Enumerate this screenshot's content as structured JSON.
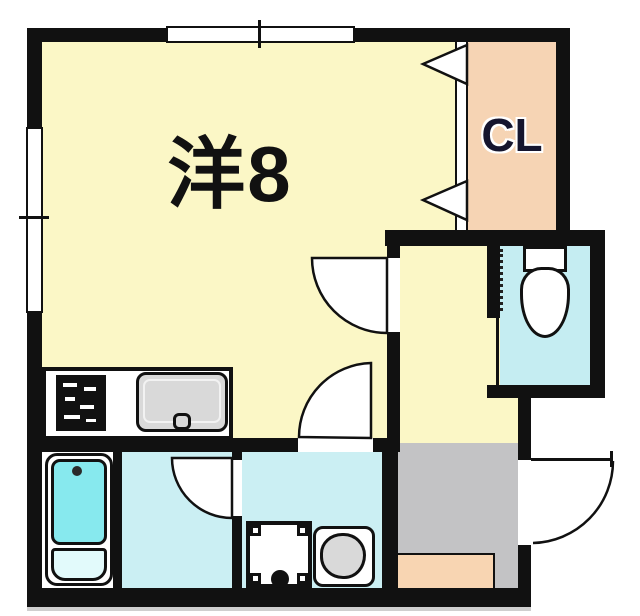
{
  "floor_plan": {
    "type": "japanese-apartment-floor-plan",
    "rooms": {
      "main_room": {
        "label": "洋8",
        "color": "#FBF7C6"
      },
      "closet": {
        "label": "CL",
        "color": "#F6D4B4"
      },
      "hallway": {
        "color": "#FBF7C6"
      },
      "toilet": {
        "color": "#C5EDF2"
      },
      "bathroom": {
        "color": "#CBEFF3"
      },
      "washroom": {
        "color": "#CBEFF3"
      },
      "entrance": {
        "color": "#C3C3C5",
        "step_color": "#F8D5B2"
      }
    },
    "fixtures": [
      "bathtub",
      "toilet",
      "stove",
      "kitchen-sink",
      "washing-machine-pan",
      "vanity-basin"
    ],
    "palette": {
      "wall": "#111111",
      "background": "#FFFFFF",
      "bathtub": "#87E9EE",
      "fixture_gray": "#D9D9D9"
    }
  }
}
